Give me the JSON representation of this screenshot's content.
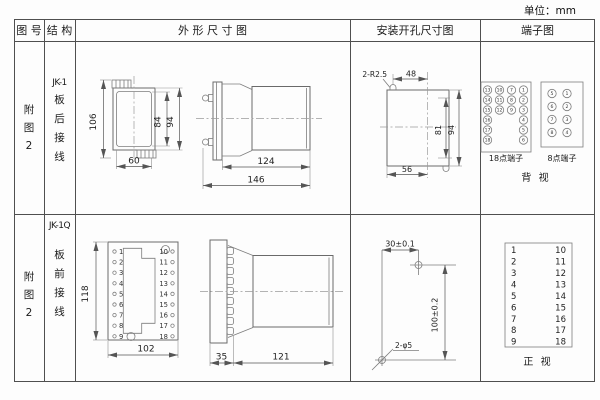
{
  "unit_label": "单位：mm",
  "headers": {
    "fig_no": "图 号",
    "structure": "结 构",
    "outline": "外 形 尺 寸 图",
    "install": "安装开孔尺寸图",
    "terminal": "端子图"
  },
  "row1": {
    "fig_no": [
      "附",
      "图",
      "2"
    ],
    "model": "JK-1",
    "wiring": [
      "板",
      "后",
      "接",
      "线"
    ],
    "front": {
      "h_total": "106",
      "h_inner": "84",
      "h_outer": "94",
      "w": "60"
    },
    "side": {
      "body": "124",
      "total": "146"
    },
    "install": {
      "notch": "2-R2.5",
      "top_w": "48",
      "h_inner": "81",
      "h_outer": "94",
      "bottom_w": "56"
    },
    "t18": {
      "label": "18点端子",
      "col1": [
        "13",
        "14",
        "15",
        "16",
        "17",
        "18"
      ],
      "col2": [
        "10",
        "11",
        "12"
      ],
      "col3": [
        "7",
        "8",
        "9"
      ],
      "col4": [
        "1",
        "2",
        "3",
        "4",
        "5",
        "6"
      ]
    },
    "t8": {
      "label": "8点端子",
      "col1": [
        "5",
        "6",
        "7",
        "8"
      ],
      "col2": [
        "1",
        "2",
        "3",
        "4"
      ]
    },
    "view": "背  视"
  },
  "row2": {
    "fig_no": [
      "附",
      "图",
      "2"
    ],
    "model": "JK-1Q",
    "wiring": [
      "板",
      "前",
      "接",
      "线"
    ],
    "front": {
      "h": "118",
      "w": "102",
      "left": [
        "1",
        "2",
        "3",
        "4",
        "5",
        "6",
        "7",
        "8",
        "9"
      ],
      "right": [
        "10",
        "11",
        "12",
        "13",
        "14",
        "15",
        "16",
        "17",
        "18"
      ]
    },
    "side": {
      "flange": "35",
      "body": "121"
    },
    "install": {
      "h_dim": "30±0.1",
      "v_dim": "100±0.2",
      "holes": "2-φ5"
    },
    "ttable": {
      "left": [
        "1",
        "2",
        "3",
        "4",
        "5",
        "6",
        "7",
        "8",
        "9"
      ],
      "right": [
        "10",
        "11",
        "12",
        "13",
        "14",
        "15",
        "16",
        "17",
        "18"
      ],
      "view": "正  视"
    }
  }
}
